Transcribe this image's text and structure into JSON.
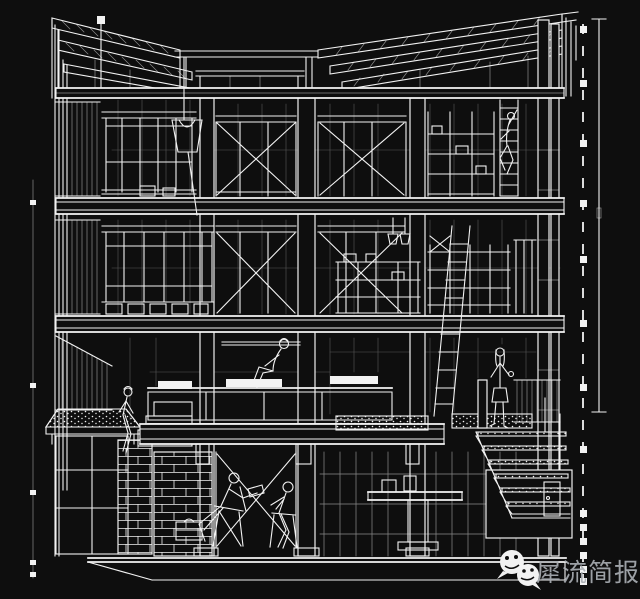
{
  "colors": {
    "background": "#0e0e0e",
    "line": "#f2f2f2",
    "watermark_text": "#a9adb2"
  },
  "watermark": {
    "text": "犀流简报",
    "icons": [
      "wechat-icon",
      "wechat-icon"
    ]
  }
}
